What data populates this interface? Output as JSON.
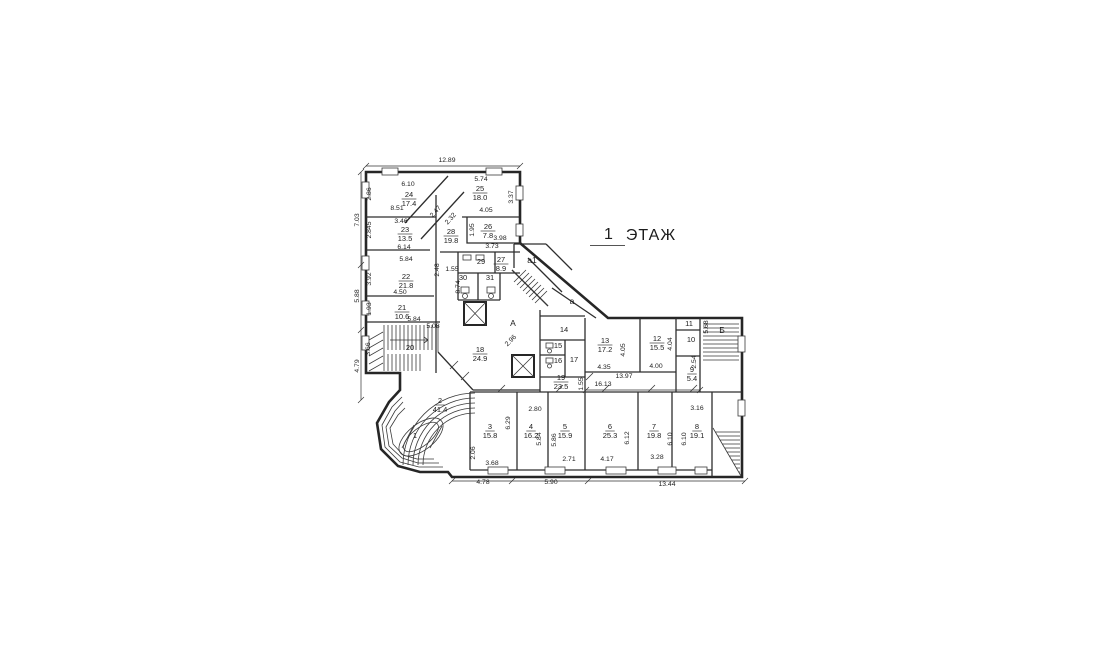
{
  "title": {
    "floor_number": "1",
    "floor_word": "ЭТАЖ"
  },
  "colors": {
    "ink": "#1c1c1c",
    "background": "#ffffff"
  },
  "plan": {
    "rooms": [
      {
        "num": "1",
        "x": 415,
        "y": 438
      },
      {
        "num": "2",
        "area": "41.4",
        "x": 440,
        "y": 403
      },
      {
        "num": "3",
        "area": "15.8",
        "x": 490,
        "y": 429
      },
      {
        "num": "4",
        "area": "16.2",
        "x": 531,
        "y": 429
      },
      {
        "num": "5",
        "area": "15.9",
        "x": 565,
        "y": 429
      },
      {
        "num": "6",
        "area": "25.3",
        "x": 610,
        "y": 429
      },
      {
        "num": "7",
        "area": "19.8",
        "x": 654,
        "y": 429
      },
      {
        "num": "8",
        "area": "19.1",
        "x": 697,
        "y": 429
      },
      {
        "num": "9",
        "area": "5.4",
        "x": 692,
        "y": 372
      },
      {
        "num": "10",
        "x": 691,
        "y": 342
      },
      {
        "num": "11",
        "x": 689,
        "y": 326
      },
      {
        "num": "12",
        "area": "15.5",
        "x": 657,
        "y": 341
      },
      {
        "num": "13",
        "area": "17.2",
        "x": 605,
        "y": 343
      },
      {
        "num": "14",
        "x": 564,
        "y": 332
      },
      {
        "num": "15",
        "x": 558,
        "y": 348
      },
      {
        "num": "16",
        "x": 558,
        "y": 363
      },
      {
        "num": "17",
        "x": 574,
        "y": 362
      },
      {
        "num": "18",
        "area": "24.9",
        "x": 480,
        "y": 352
      },
      {
        "num": "19",
        "area": "23.5",
        "x": 561,
        "y": 380
      },
      {
        "num": "20",
        "x": 410,
        "y": 350
      },
      {
        "num": "21",
        "area": "10.6",
        "x": 402,
        "y": 310
      },
      {
        "num": "22",
        "area": "21.8",
        "x": 406,
        "y": 279
      },
      {
        "num": "23",
        "area": "13.5",
        "x": 405,
        "y": 232
      },
      {
        "num": "24",
        "area": "17.4",
        "x": 409,
        "y": 197
      },
      {
        "num": "25",
        "area": "18.0",
        "x": 480,
        "y": 191
      },
      {
        "num": "26",
        "area": "7.8",
        "x": 488,
        "y": 229
      },
      {
        "num": "27",
        "area": "8.9",
        "x": 501,
        "y": 262
      },
      {
        "num": "28",
        "area": "19.8",
        "x": 451,
        "y": 234
      },
      {
        "num": "29",
        "x": 481,
        "y": 264
      },
      {
        "num": "30",
        "x": 463,
        "y": 280
      },
      {
        "num": "31",
        "x": 490,
        "y": 280
      }
    ],
    "letters": [
      {
        "t": "А",
        "x": 513,
        "y": 326
      },
      {
        "t": "а",
        "x": 572,
        "y": 304
      },
      {
        "t": "а1",
        "x": 532,
        "y": 263
      },
      {
        "t": "Б",
        "x": 722,
        "y": 333
      }
    ],
    "dims": [
      {
        "t": "12.89",
        "x": 447,
        "y": 162,
        "r": 0
      },
      {
        "t": "6.10",
        "x": 408,
        "y": 186,
        "r": 0
      },
      {
        "t": "5.74",
        "x": 481,
        "y": 181,
        "r": 0
      },
      {
        "t": "2.86",
        "x": 371,
        "y": 194,
        "r": -90
      },
      {
        "t": "3.37",
        "x": 513,
        "y": 197,
        "r": -90
      },
      {
        "t": "8.51",
        "x": 397,
        "y": 210,
        "r": 0
      },
      {
        "t": "4.05",
        "x": 486,
        "y": 212,
        "r": 0
      },
      {
        "t": "7.03",
        "x": 359,
        "y": 220,
        "r": -90
      },
      {
        "t": "2.47",
        "x": 437,
        "y": 213,
        "r": -48
      },
      {
        "t": "2.32",
        "x": 452,
        "y": 220,
        "r": -48
      },
      {
        "t": "3.46",
        "x": 401,
        "y": 223,
        "r": 0
      },
      {
        "t": "1.95",
        "x": 474,
        "y": 230,
        "r": -90
      },
      {
        "t": "2.845",
        "x": 371,
        "y": 230,
        "r": -90
      },
      {
        "t": "3.98",
        "x": 500,
        "y": 240,
        "r": 0
      },
      {
        "t": "6.14",
        "x": 404,
        "y": 249,
        "r": 0
      },
      {
        "t": "3.73",
        "x": 492,
        "y": 248,
        "r": 0
      },
      {
        "t": "5.84",
        "x": 406,
        "y": 261,
        "r": 0
      },
      {
        "t": "1.55",
        "x": 452,
        "y": 271,
        "r": 0
      },
      {
        "t": "2.48",
        "x": 439,
        "y": 270,
        "r": -90
      },
      {
        "t": "3.92",
        "x": 371,
        "y": 279,
        "r": -90
      },
      {
        "t": "8.74",
        "x": 460,
        "y": 287,
        "r": -90
      },
      {
        "t": "5.88",
        "x": 359,
        "y": 296,
        "r": -90
      },
      {
        "t": "4.50",
        "x": 400,
        "y": 294,
        "r": 0
      },
      {
        "t": "1.93",
        "x": 371,
        "y": 309,
        "r": -90
      },
      {
        "t": "5.84",
        "x": 414,
        "y": 321,
        "r": 0
      },
      {
        "t": "5.08",
        "x": 433,
        "y": 328,
        "r": 0
      },
      {
        "t": "3.66",
        "x": 370,
        "y": 349,
        "r": -90
      },
      {
        "t": "4.79",
        "x": 359,
        "y": 366,
        "r": -90
      },
      {
        "t": "2.96",
        "x": 512,
        "y": 342,
        "r": -45
      },
      {
        "t": "5.68",
        "x": 708,
        "y": 327,
        "r": -90
      },
      {
        "t": "2.54",
        "x": 696,
        "y": 362,
        "r": -90
      },
      {
        "t": "4.05",
        "x": 625,
        "y": 350,
        "r": -90
      },
      {
        "t": "4.04",
        "x": 672,
        "y": 344,
        "r": -90
      },
      {
        "t": "4.35",
        "x": 604,
        "y": 369,
        "r": 0
      },
      {
        "t": "4.00",
        "x": 656,
        "y": 368,
        "r": 0
      },
      {
        "t": "13.97",
        "x": 624,
        "y": 378,
        "r": 0
      },
      {
        "t": "16.13",
        "x": 603,
        "y": 386,
        "r": 0
      },
      {
        "t": "1.55",
        "x": 583,
        "y": 384,
        "r": -90
      },
      {
        "t": "2.80",
        "x": 535,
        "y": 411,
        "r": 0
      },
      {
        "t": "3.16",
        "x": 697,
        "y": 410,
        "r": 0
      },
      {
        "t": "6.29",
        "x": 510,
        "y": 423,
        "r": -90
      },
      {
        "t": "5.84",
        "x": 541,
        "y": 439,
        "r": -90
      },
      {
        "t": "5.86",
        "x": 556,
        "y": 440,
        "r": -90
      },
      {
        "t": "6.12",
        "x": 629,
        "y": 438,
        "r": -90
      },
      {
        "t": "6.10",
        "x": 672,
        "y": 439,
        "r": -90
      },
      {
        "t": "6.10",
        "x": 686,
        "y": 439,
        "r": -90
      },
      {
        "t": "2.06",
        "x": 475,
        "y": 453,
        "r": -90
      },
      {
        "t": "3.68",
        "x": 492,
        "y": 465,
        "r": 0
      },
      {
        "t": "2.71",
        "x": 569,
        "y": 461,
        "r": 0
      },
      {
        "t": "4.17",
        "x": 607,
        "y": 461,
        "r": 0
      },
      {
        "t": "3.28",
        "x": 657,
        "y": 459,
        "r": 0
      },
      {
        "t": "4.78",
        "x": 483,
        "y": 484,
        "r": 0
      },
      {
        "t": "5.90",
        "x": 551,
        "y": 484,
        "r": 0
      },
      {
        "t": "13.44",
        "x": 667,
        "y": 486,
        "r": 0
      }
    ]
  }
}
